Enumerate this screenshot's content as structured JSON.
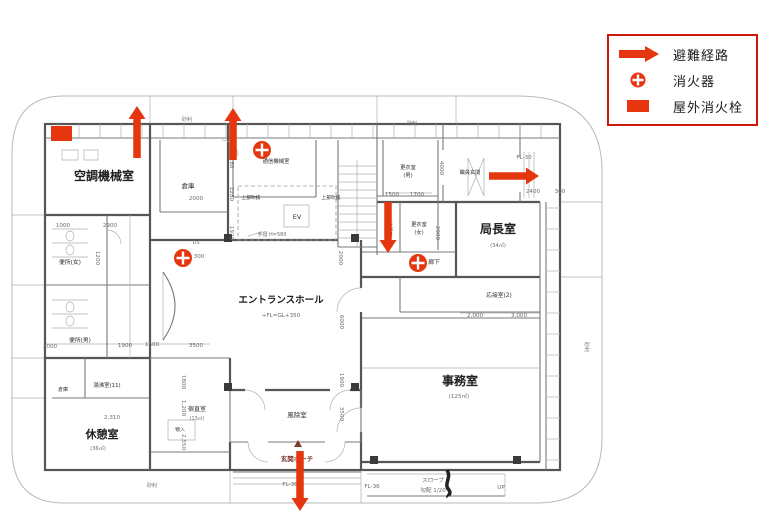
{
  "colors": {
    "marker_red": "#e5360f",
    "legend_border": "#cb1a0a",
    "porch": "#7b3a2c"
  },
  "legend": {
    "items": [
      {
        "id": "evacuation-route",
        "symbol": "arrow",
        "label": "避難経路"
      },
      {
        "id": "fire-extinguisher",
        "symbol": "extinguisher",
        "label": "消火器"
      },
      {
        "id": "outdoor-hydrant",
        "symbol": "hydrant",
        "label": "屋外消火栓"
      }
    ]
  },
  "plan": {
    "texts": [
      {
        "t": "空調機械室",
        "x": 104,
        "y": 180,
        "s": 12,
        "c": "room"
      },
      {
        "t": "エントランスホール",
        "x": 281,
        "y": 303,
        "s": 9.5,
        "c": "room"
      },
      {
        "t": "休憩室",
        "x": 102,
        "y": 438,
        "s": 11,
        "c": "room"
      },
      {
        "t": "事務室",
        "x": 460,
        "y": 385,
        "s": 12,
        "c": "room"
      },
      {
        "t": "局長室",
        "x": 498,
        "y": 233,
        "s": 12,
        "c": "room"
      },
      {
        "t": "倉庫",
        "x": 188,
        "y": 188,
        "s": 6.5,
        "c": "small"
      },
      {
        "t": "通信機械室",
        "x": 276,
        "y": 163,
        "s": 5.4,
        "c": "small"
      },
      {
        "t": "EV",
        "x": 297,
        "y": 219,
        "s": 6.5,
        "c": "small"
      },
      {
        "t": "上部吹抜",
        "x": 251,
        "y": 199,
        "s": 4.8,
        "c": "small"
      },
      {
        "t": "上部吹抜",
        "x": 331,
        "y": 199,
        "s": 4.8,
        "c": "small"
      },
      {
        "t": "便所(女)",
        "x": 70,
        "y": 264,
        "s": 5.8,
        "c": "small"
      },
      {
        "t": "便所(男)",
        "x": 80,
        "y": 342,
        "s": 5.8,
        "c": "small"
      },
      {
        "t": "湯沸室(11)",
        "x": 107,
        "y": 387,
        "s": 5.4,
        "c": "small"
      },
      {
        "t": "倉庫",
        "x": 63,
        "y": 391,
        "s": 5,
        "c": "small"
      },
      {
        "t": "宿直室",
        "x": 197,
        "y": 411,
        "s": 6,
        "c": "small"
      },
      {
        "t": "物入",
        "x": 180,
        "y": 431,
        "s": 4.8,
        "c": "small"
      },
      {
        "t": "風除室",
        "x": 297,
        "y": 417,
        "s": 6.5,
        "c": "small"
      },
      {
        "t": "応接室(2)",
        "x": 499,
        "y": 297,
        "s": 5.8,
        "c": "small"
      },
      {
        "t": "廊下",
        "x": 434,
        "y": 264,
        "s": 5.8,
        "c": "small"
      },
      {
        "t": "更衣室",
        "x": 408,
        "y": 169,
        "s": 5.2,
        "c": "small"
      },
      {
        "t": "(男)",
        "x": 408,
        "y": 177,
        "s": 5.2,
        "c": "small"
      },
      {
        "t": "職員玄関",
        "x": 470,
        "y": 174,
        "s": 5.2,
        "c": "small"
      },
      {
        "t": "更衣室",
        "x": 419,
        "y": 226,
        "s": 5.2,
        "c": "small"
      },
      {
        "t": "(女)",
        "x": 419,
        "y": 234,
        "s": 5.2,
        "c": "small"
      },
      {
        "t": "給湯室",
        "x": 388,
        "y": 229,
        "s": 5,
        "c": "small",
        "r": 90
      },
      {
        "t": "玄関ポーチ",
        "x": 297,
        "y": 461,
        "s": 6.5,
        "c": "porch"
      },
      {
        "t": "(36㎡)",
        "x": 98,
        "y": 450,
        "s": 5.2
      },
      {
        "t": "(13㎡)",
        "x": 197,
        "y": 420,
        "s": 4.8
      },
      {
        "t": "(125㎡)",
        "x": 459,
        "y": 398,
        "s": 5.6
      },
      {
        "t": "(34㎡)",
        "x": 498,
        "y": 247,
        "s": 5.2
      },
      {
        "t": "+FL=GL+350",
        "x": 281,
        "y": 317,
        "s": 5.6
      },
      {
        "t": "手摺 H=580",
        "x": 272,
        "y": 236,
        "s": 5
      },
      {
        "t": "DS",
        "x": 196,
        "y": 244,
        "s": 5
      },
      {
        "t": "砂利",
        "x": 187,
        "y": 121,
        "s": 5
      },
      {
        "t": "砂利",
        "x": 412,
        "y": 125,
        "s": 5
      },
      {
        "t": "砂利",
        "x": 585,
        "y": 347,
        "s": 5,
        "r": 90
      },
      {
        "t": "砂利",
        "x": 152,
        "y": 487,
        "s": 5
      },
      {
        "t": "2000",
        "x": 196,
        "y": 200
      },
      {
        "t": "1000",
        "x": 63,
        "y": 227
      },
      {
        "t": "2900",
        "x": 110,
        "y": 227
      },
      {
        "t": "1200",
        "x": 96,
        "y": 258,
        "r": 90
      },
      {
        "t": "180",
        "x": 230,
        "y": 163,
        "r": 90
      },
      {
        "t": "2280",
        "x": 230,
        "y": 194,
        "r": 90
      },
      {
        "t": "1920",
        "x": 230,
        "y": 233,
        "r": 90
      },
      {
        "t": "300",
        "x": 199,
        "y": 258
      },
      {
        "t": "2000",
        "x": 339,
        "y": 258,
        "r": 90
      },
      {
        "t": "6000",
        "x": 340,
        "y": 322,
        "r": 90
      },
      {
        "t": "1900",
        "x": 340,
        "y": 380,
        "r": 90
      },
      {
        "t": "3500",
        "x": 340,
        "y": 414,
        "r": 90
      },
      {
        "t": "3000",
        "x": 50,
        "y": 348
      },
      {
        "t": "1900",
        "x": 125,
        "y": 347
      },
      {
        "t": "1600",
        "x": 152,
        "y": 346
      },
      {
        "t": "3500",
        "x": 196,
        "y": 347
      },
      {
        "t": "2,310",
        "x": 112,
        "y": 419
      },
      {
        "t": "1800",
        "x": 182,
        "y": 382,
        "r": 90
      },
      {
        "t": "1,200",
        "x": 182,
        "y": 408,
        "r": 90
      },
      {
        "t": "2,550",
        "x": 182,
        "y": 442,
        "r": 90
      },
      {
        "t": "1500",
        "x": 392,
        "y": 196
      },
      {
        "t": "1700",
        "x": 417,
        "y": 196
      },
      {
        "t": "4000",
        "x": 440,
        "y": 168,
        "r": 90
      },
      {
        "t": "2000",
        "x": 436,
        "y": 233,
        "r": 90
      },
      {
        "t": "FL-30",
        "x": 524,
        "y": 159
      },
      {
        "t": "2400",
        "x": 533,
        "y": 193
      },
      {
        "t": "300",
        "x": 560,
        "y": 193
      },
      {
        "t": "2.000",
        "x": 475,
        "y": 317
      },
      {
        "t": "3.000",
        "x": 519,
        "y": 317
      },
      {
        "t": "FL-36",
        "x": 290,
        "y": 486
      },
      {
        "t": "FL-36",
        "x": 372,
        "y": 488
      },
      {
        "t": "スロープ",
        "x": 433,
        "y": 482
      },
      {
        "t": "勾配 1/20",
        "x": 433,
        "y": 492
      },
      {
        "t": "UP",
        "x": 501,
        "y": 489
      }
    ],
    "markers": {
      "evacuation_arrows": [
        {
          "x1": 137,
          "y1": 158,
          "x2": 137,
          "y2": 106
        },
        {
          "x1": 233,
          "y1": 160,
          "x2": 233,
          "y2": 108
        },
        {
          "x1": 388,
          "y1": 202,
          "x2": 388,
          "y2": 253
        },
        {
          "x1": 489,
          "y1": 176,
          "x2": 539,
          "y2": 176
        },
        {
          "x1": 300,
          "y1": 451,
          "x2": 300,
          "y2": 511
        }
      ],
      "extinguishers": [
        {
          "x": 262,
          "y": 150
        },
        {
          "x": 183,
          "y": 258
        },
        {
          "x": 418,
          "y": 263
        }
      ],
      "hydrants": [
        {
          "x": 51,
          "y": 126,
          "w": 21,
          "h": 15
        }
      ]
    }
  }
}
